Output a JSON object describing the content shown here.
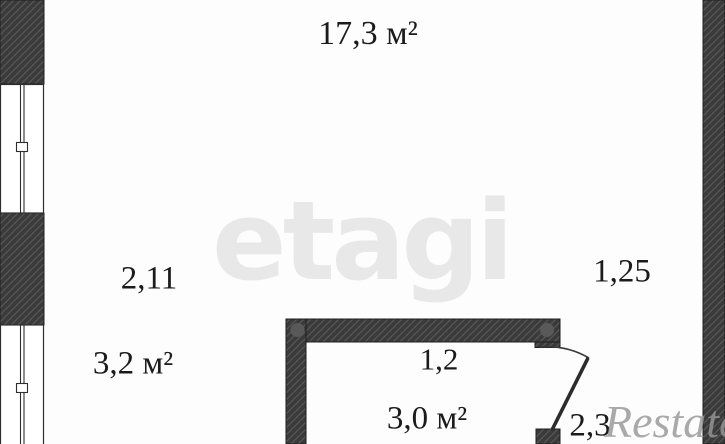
{
  "colors": {
    "background": "#fdfdfd",
    "wall_fill": "#3a3a3a",
    "hatch_line": "#565656",
    "wall_outline": "#1f1f1f",
    "window_line": "#2e2e2e",
    "door_line": "#2b2b2b",
    "riser_dot": "#595959",
    "label_text": "#1b1b1b",
    "etagi_watermark": "#e8e8e8",
    "restate_watermark": "#969696"
  },
  "labels": {
    "main_room_area": "17,3 м²",
    "dim_left_width": "2,11",
    "dim_right_width": "1,25",
    "balcony_area": "3,2 м²",
    "inner_room_width": "1,2",
    "inner_room_area": "3,0 м²",
    "door_dim": "2,3"
  },
  "watermarks": {
    "etagi": "etagi",
    "restate": "Restate"
  }
}
